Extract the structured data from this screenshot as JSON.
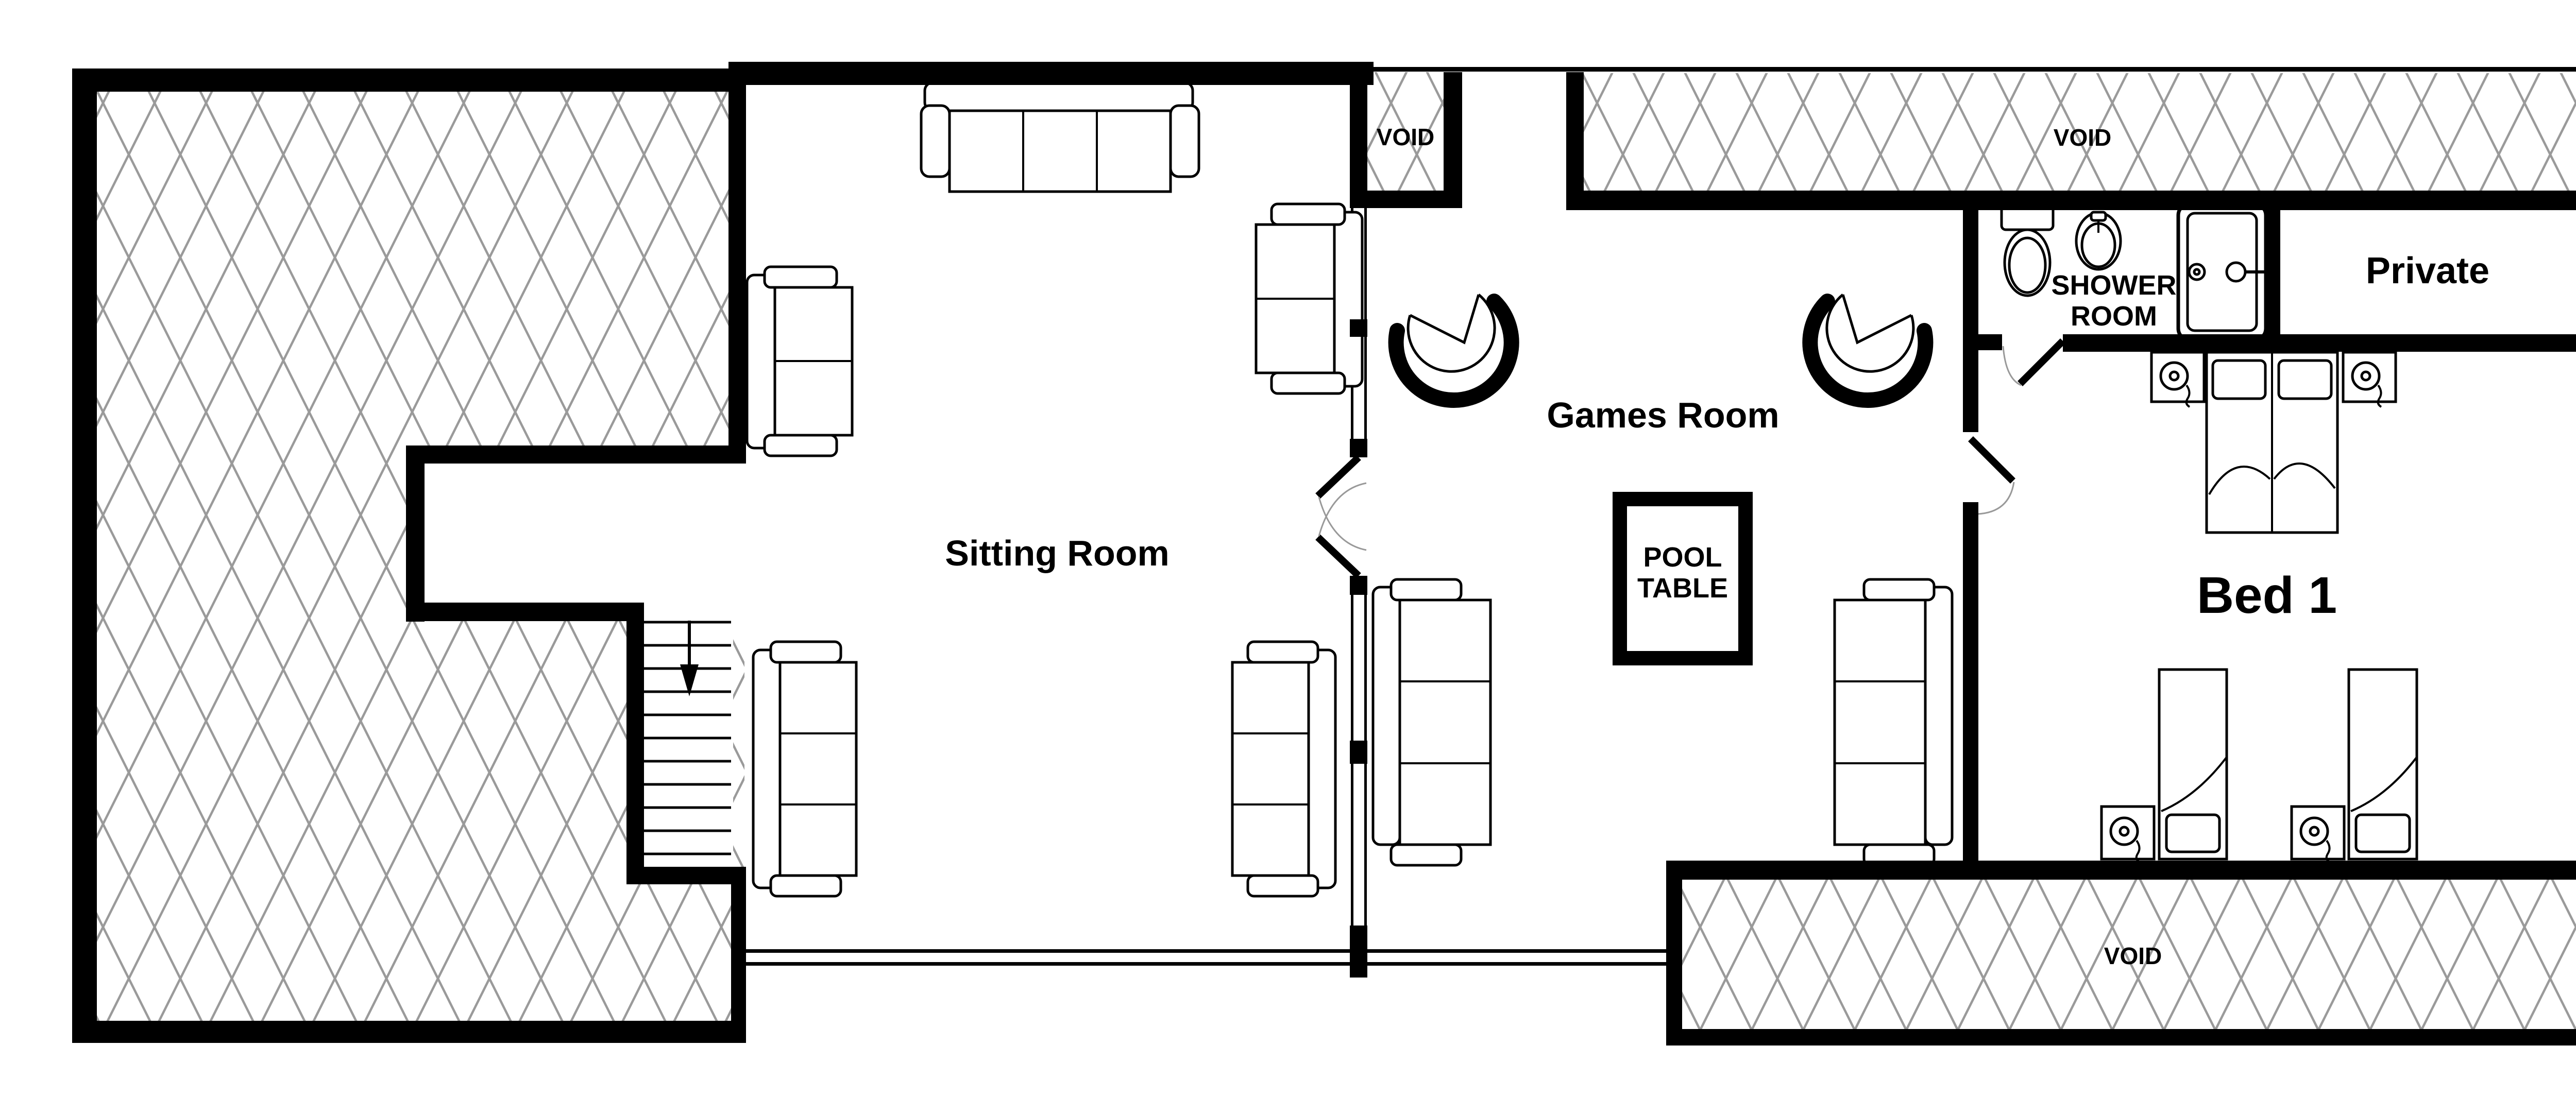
{
  "colors": {
    "wall": "#000000",
    "background": "#ffffff",
    "hatch_lines": "#9a9a9a",
    "door_arc": "#999999",
    "text": "#000000"
  },
  "rooms": {
    "sitting": {
      "label": "Sitting Room"
    },
    "games": {
      "label": "Games Room"
    },
    "bed1": {
      "label": "Bed 1"
    },
    "private": {
      "label": "Private"
    },
    "shower": {
      "label_line1": "SHOWER",
      "label_line2": "ROOM"
    }
  },
  "fixtures": {
    "pool_table": {
      "label_line1": "POOL",
      "label_line2": "TABLE"
    }
  },
  "voids": {
    "mid": {
      "label": "VOID"
    },
    "top": {
      "label": "VOID"
    },
    "bottom": {
      "label": "VOID"
    }
  }
}
